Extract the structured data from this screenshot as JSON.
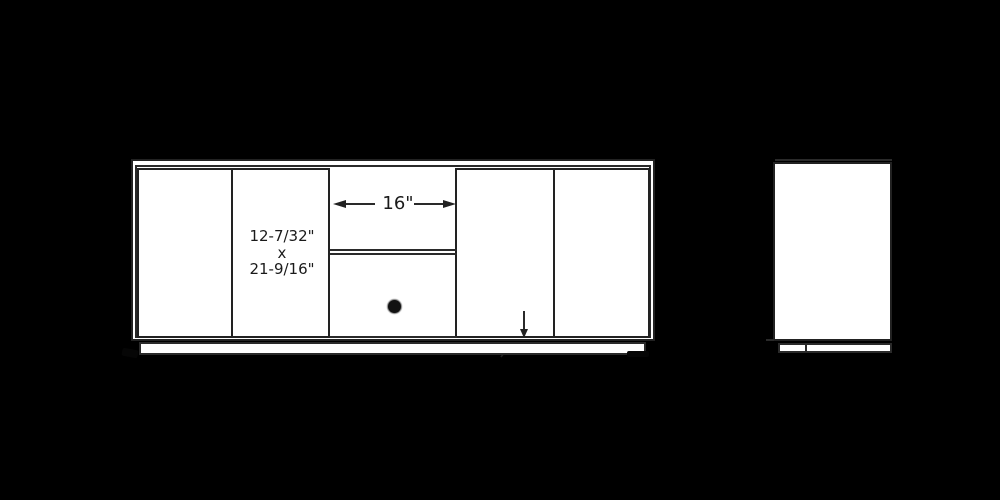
{
  "colors": {
    "background": "#000000",
    "paper": "#ffffff",
    "line": "#222222",
    "text": "#1a1a1a",
    "knob": "#111111"
  },
  "front_view": {
    "center_opening_dimension": {
      "label": "16\""
    },
    "door_size_dimension": {
      "line1": "12-7/32\"",
      "line2": "x",
      "line3": "21-9/16\""
    }
  }
}
